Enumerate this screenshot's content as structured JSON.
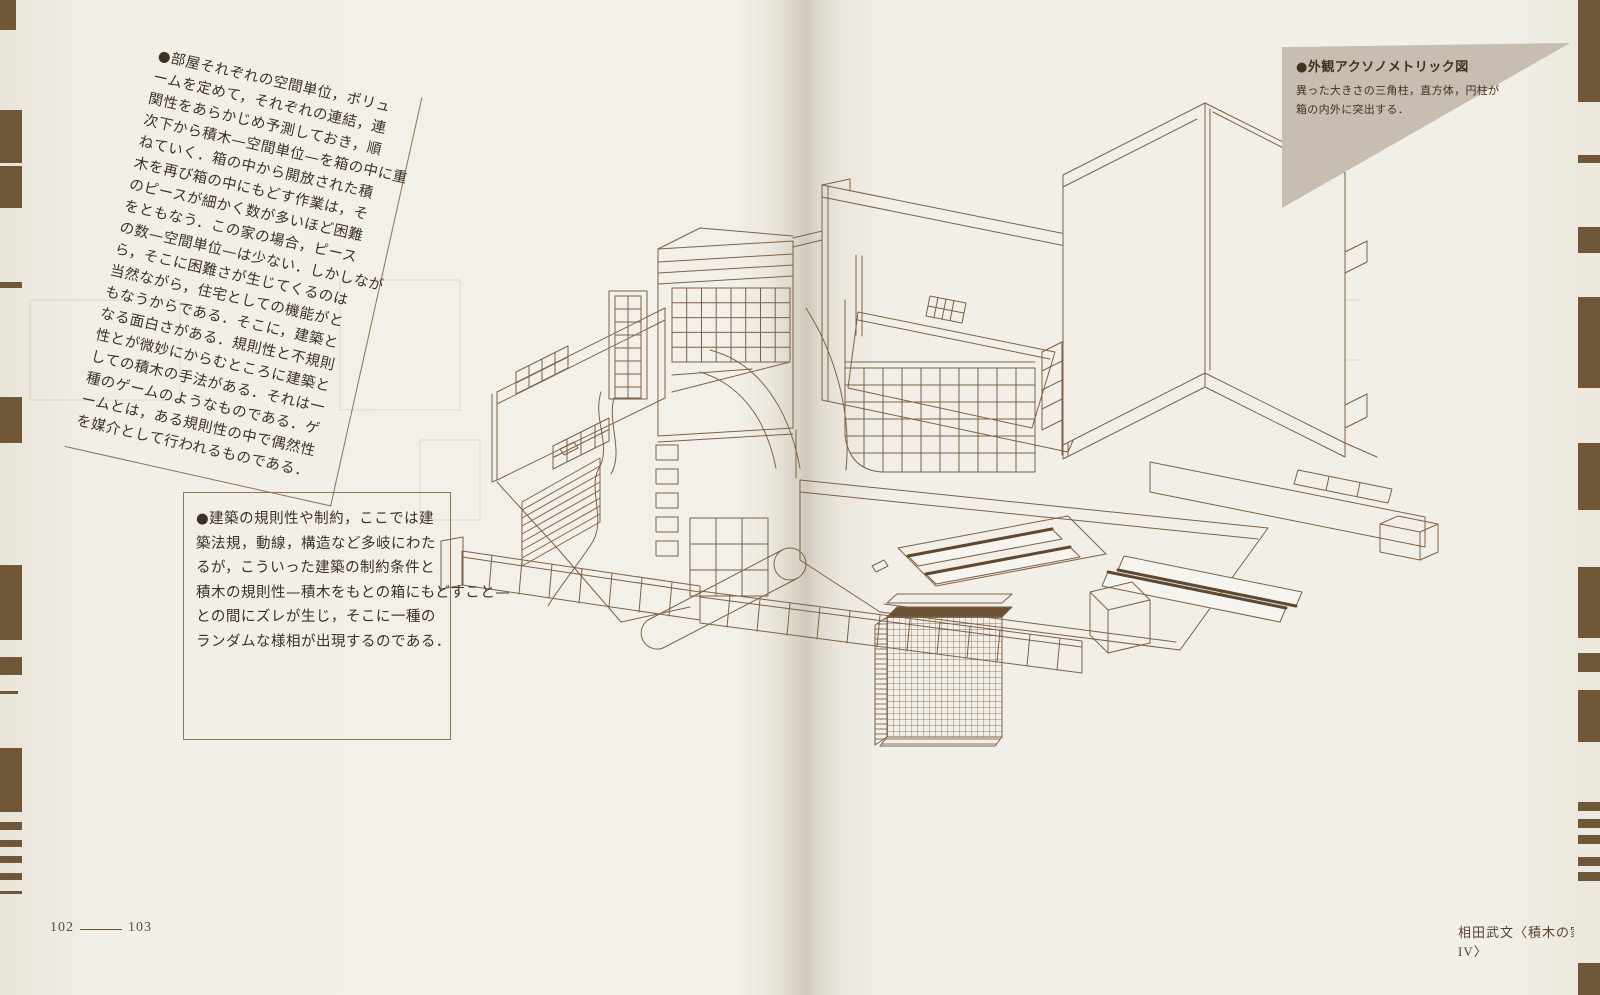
{
  "colors": {
    "paper": "#f2efe8",
    "drawing_ink": "#7d6146",
    "edge_bar_brown": "#6e5637",
    "caption_triangle_tan": "#c7bdb0",
    "text_ink": "#3e3022"
  },
  "notes": {
    "tilted": {
      "lines": [
        "●部屋それぞれの空間単位，ボリュ",
        "ームを定めて，それぞれの連結，連",
        "関性をあらかじめ予測しておき，順",
        "次下から積木—空間単位—を箱の中に重",
        "ねていく．箱の中から開放された積",
        "木を再び箱の中にもどす作業は，そ",
        "のピースが細かく数が多いほど困難",
        "をともなう．この家の場合，ピース",
        "の数—空間単位—は少ない．しかしなが",
        "ら，そこに困難さが生じてくるのは",
        "当然ながら，住宅としての機能がと",
        "もなうからである．そこに，建築と",
        "なる面白さがある．規則性と不規則",
        "性とが微妙にからむところに建築と",
        "しての積木の手法がある．それは一",
        "種のゲームのようなものである．ゲ",
        "ームとは，ある規則性の中で偶然性",
        "を媒介として行われるものである．"
      ]
    },
    "boxed": {
      "lines": [
        "●建築の規則性や制約，ここでは建",
        "築法規，動線，構造など多岐にわた",
        "るが，こういった建築の制約条件と",
        "積木の規則性—積木をもとの箱にもどすこと—",
        "との間にズレが生じ，そこに一種の",
        "ランダムな様相が出現するのである．"
      ]
    }
  },
  "figure_caption": {
    "title": "●外観アクソノメトリック図",
    "lines": [
      "異った大きさの三角柱，直方体，円柱が",
      "箱の内外に突出する．"
    ]
  },
  "footer": {
    "left_page_number": "102",
    "right_page_number": "103",
    "credit": "相田武文〈積木の家IV〉"
  }
}
